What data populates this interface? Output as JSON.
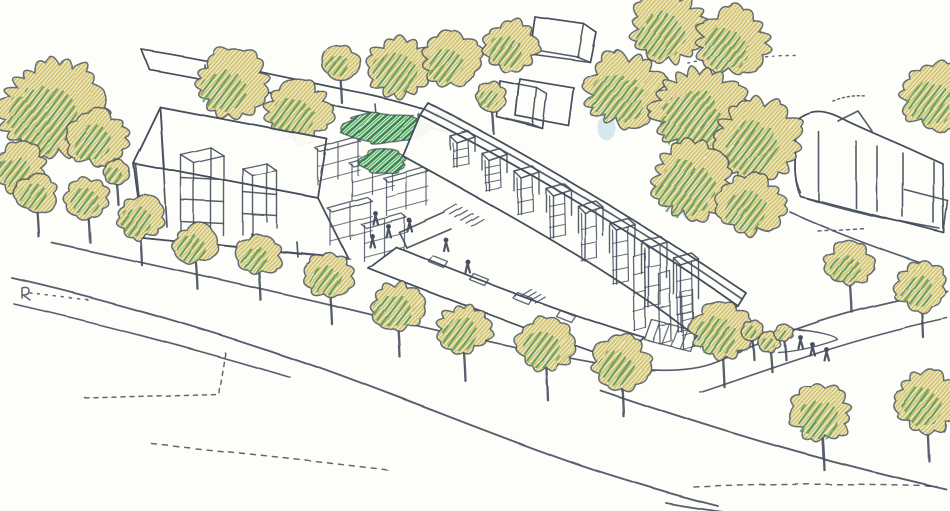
{
  "scene": {
    "description": "Hand-drawn ink and coloured-pencil aerial perspective sketch of a terraced housing scheme with chimney towers, a large gabled hall, background blocks, tree-lined street, roads and small human figures",
    "canvas": {
      "w": 950,
      "h": 511
    },
    "palette": {
      "paper": "#fdfdfa",
      "ink": "#454e5c",
      "foliage_base": "#f5f0d4",
      "foliage_yellow": "#d6c978",
      "foliage_yellow_dark": "#c5b55e",
      "foliage_green": "#5a9a60",
      "foliage_dark_green": "#2f8a4b",
      "foliage_dark_green2": "#4aa05e",
      "shrub_base": "#eef3e2",
      "blue_hint": "#aed3e6"
    },
    "back_trees": [
      [
        52,
        108,
        52,
        0.55,
        0
      ],
      [
        98,
        138,
        30,
        0.5,
        0
      ],
      [
        20,
        168,
        26,
        0.5,
        0
      ],
      [
        37,
        193,
        21,
        0.6,
        1
      ],
      [
        88,
        197,
        22,
        0.55,
        1
      ],
      [
        116,
        172,
        13,
        0.5,
        1
      ],
      [
        232,
        84,
        36,
        0.5,
        0
      ],
      [
        298,
        112,
        33,
        0.55,
        0
      ],
      [
        340,
        62,
        19,
        0.45,
        1
      ],
      [
        400,
        67,
        33,
        0.6,
        0
      ],
      [
        451,
        59,
        29,
        0.5,
        0
      ],
      [
        511,
        45,
        27,
        0.5,
        0
      ],
      [
        492,
        97,
        16,
        0.5,
        1
      ],
      [
        625,
        90,
        40,
        0.55,
        0
      ],
      [
        668,
        28,
        38,
        0.5,
        0
      ],
      [
        732,
        42,
        36,
        0.5,
        0
      ],
      [
        700,
        112,
        46,
        0.6,
        0
      ],
      [
        758,
        140,
        42,
        0.55,
        0
      ],
      [
        692,
        180,
        40,
        0.65,
        0
      ],
      [
        752,
        205,
        33,
        0.5,
        0
      ],
      [
        936,
        96,
        35,
        0.5,
        0
      ],
      [
        850,
        264,
        24,
        0.45,
        1
      ],
      [
        921,
        286,
        26,
        0.5,
        1
      ]
    ],
    "street_trees": [
      [
        140,
        217,
        24,
        0.55
      ],
      [
        196,
        244,
        22,
        0.6
      ],
      [
        259,
        255,
        22,
        0.55
      ],
      [
        330,
        276,
        24,
        0.6
      ],
      [
        398,
        306,
        26,
        0.65
      ],
      [
        464,
        329,
        27,
        0.6
      ],
      [
        546,
        345,
        29,
        0.6
      ],
      [
        621,
        362,
        28,
        0.55
      ],
      [
        722,
        330,
        30,
        0.6
      ],
      [
        822,
        413,
        30,
        0.6
      ],
      [
        927,
        400,
        33,
        0.5
      ],
      [
        752,
        330,
        11,
        0.45
      ],
      [
        770,
        342,
        11,
        0.5
      ],
      [
        784,
        333,
        9,
        0.45
      ]
    ],
    "shrubs": [
      [
        385,
        128,
        42,
        15
      ],
      [
        383,
        162,
        24,
        13
      ]
    ],
    "blue_hints": [
      [
        648,
        12,
        13,
        8
      ],
      [
        607,
        128,
        9,
        13
      ],
      [
        589,
        203,
        7,
        11
      ],
      [
        688,
        209,
        7,
        10
      ]
    ],
    "figures": {
      "plaza": [
        [
          375,
          216
        ],
        [
          388,
          229
        ],
        [
          409,
          223
        ],
        [
          372,
          239
        ],
        [
          446,
          243
        ],
        [
          468,
          265
        ]
      ],
      "junction": [
        [
          800,
          340
        ],
        [
          812,
          347
        ],
        [
          826,
          352
        ]
      ]
    },
    "roads": [
      {
        "name": "kerb-line",
        "d": "M52,243 C140,262 240,284 330,305 C420,327 520,350 600,364 C650,372 690,372 715,362 C750,347 790,330 830,318 C870,306 915,296 947,291",
        "w": 1.7
      },
      {
        "name": "road-far-edge",
        "d": "M12,278 C110,300 220,333 320,368 C420,404 520,446 600,472 C650,488 690,499 718,506",
        "w": 1.9
      },
      {
        "name": "road-near-edge",
        "d": "M14,304 C110,326 200,350 290,377",
        "w": 1.6
      },
      {
        "name": "road-lower-edge",
        "d": "M600,390 C700,424 800,456 946,489",
        "w": 1.9
      },
      {
        "name": "branch-road-edge",
        "d": "M700,392 C760,372 820,350 880,334 C910,326 932,321 947,318",
        "w": 1.6
      },
      {
        "name": "road-bottom-edge",
        "d": "M666,503 C720,513 760,516 806,520",
        "w": 1.7
      },
      {
        "name": "junction-wedge",
        "d": "M792,329 C818,331 836,336 837,339 C818,346 796,351 778,352",
        "w": 1.4
      }
    ],
    "dashed": [
      {
        "name": "plot-boundary-dash",
        "d": "M85,398 L218,394 L225,352",
        "dash": "4 5"
      },
      {
        "name": "bottom-dash-left",
        "d": "M152,444 C230,452 310,460 392,470",
        "dash": "5 6"
      },
      {
        "name": "bottom-dash-right",
        "d": "M694,487 C770,484 860,483 936,486",
        "dash": "5 6"
      },
      {
        "name": "dotted-top-right",
        "d": "M688,63 C720,58 760,55 797,55",
        "dash": "2 5"
      },
      {
        "name": "dotted-roof-ticks",
        "d": "M495,97 C515,92 535,89 556,88",
        "dash": "2 5"
      },
      {
        "name": "dotted-right-block",
        "d": "M818,231 L866,228",
        "dash": "3 4"
      },
      {
        "name": "dotted-left-kerb",
        "d": "M30,293 C50,296 70,298 92,300",
        "dash": "2 6"
      },
      {
        "name": "scribble-right-block",
        "d": "M833,101 C843,97 853,95 866,96",
        "dash": "2 3"
      },
      {
        "name": "r-mark",
        "d": "M22,288 L22,298 M22,288 Q29,286 29,291 Q29,295 23,295 L30,300",
        "dash": ""
      }
    ],
    "buildings": {
      "rear_hall": {
        "fill": "M142,50 C220,62 300,81 352,91 C395,99 432,111 458,121 L464,137 C436,129 398,118 358,110 C308,101 230,84 150,70 Z",
        "strokes": [
          "M142,50 C220,62 300,81 352,91 C395,99 432,111 458,121",
          "M150,70 C230,84 308,101 358,110 C398,118 436,129 464,137",
          "M142,50 L150,70",
          "M458,121 L464,137",
          "M205,65 L206,76",
          "M262,77 L263,88",
          "M318,91 L319,102",
          "M375,104 L376,115",
          "M418,113 L419,124"
        ]
      },
      "mid_blocks": {
        "fills": [
          "M535,17 L584,24 L596,32 L590,62 L530,54 Z",
          "M500,81 L537,88 L547,94 L543,129 L497,117 Z",
          "M520,79 L574,88 L569,126 L516,116 Z"
        ],
        "strokes": [
          "M535,17 L584,24",
          "M584,24 L596,32",
          "M535,17 L530,49",
          "M530,49 L578,57",
          "M578,57 L584,24",
          "M596,32 L590,62",
          "M578,57 L590,62",
          "M500,81 L537,88",
          "M537,88 L533,125",
          "M500,81 L497,117",
          "M497,117 L533,125",
          "M537,88 L547,94",
          "M547,94 L543,129",
          "M533,125 L543,129",
          "M520,79 L574,88",
          "M574,88 L569,126",
          "M520,79 L516,116",
          "M516,116 L569,126"
        ]
      },
      "right_block": {
        "fill": "M793,123 C812,104 830,112 847,121 C868,131 890,140 910,149 L943,164 L944,233 L901,222 L800,196 C789,170 799,149 793,123 Z",
        "strokes": [
          "M793,123 C812,104 830,112 847,121 C868,131 890,140 910,149 L943,164",
          "M838,121 L858,111 L872,131",
          "M793,123 C799,149 789,170 800,192",
          "M818,131 L818,201",
          "M856,141 L856,208",
          "M877,146 L877,211",
          "M903,153 L903,217",
          "M934,162 L934,223",
          "M800,196 C840,209 882,219 940,229",
          "M905,190 L948,201",
          "M948,201 L944,233",
          "M944,233 L901,222",
          "M790,212 C832,231 874,247 922,263"
        ]
      },
      "left_house": {
        "fills": [
          "M160,107 L327,139 L318,198 L133,163 Z",
          "M160,107 L133,163 L143,238 L168,227 Z",
          "M133,163 L318,198 L348,258 L143,238 Z"
        ],
        "strokes": [
          "M133,163 L160,107",
          "M160,107 L327,139",
          "M327,139 L318,198",
          "M318,198 L133,163",
          "M135,164 L143,238",
          "M143,238 L350,259",
          "M348,258 L318,198",
          "M160,108 L167,227",
          "M203,227 L204,245",
          "M252,234 L253,251",
          "M297,242 L298,257"
        ],
        "towers": [
          [
            "M181,155 L211,148",
            "M211,148 L224,156",
            "M224,156 L194,163",
            "M194,163 L181,155",
            "M181,155 L181,242",
            "M211,148 L211,228",
            "M224,156 L224,236",
            "M194,163 L194,248",
            "M181,178 L224,180",
            "M181,200 L224,202",
            "M181,222 L224,224"
          ],
          [
            "M243,169 L267,164",
            "M267,164 L277,171",
            "M277,171 L253,176",
            "M253,176 L243,169",
            "M243,169 L243,235",
            "M267,164 L267,222",
            "M277,171 L277,228",
            "M253,176 L253,240",
            "M243,192 L277,195",
            "M243,214 L277,216"
          ]
        ]
      },
      "terrace": {
        "fills": [
          "M428,103 C530,155 650,228 746,293 L738,306 C645,240 525,168 420,115 Z",
          "M420,115 C525,168 645,240 738,306 L689,331 C610,270 505,212 403,156 Z"
        ],
        "strokes": [
          "M428,103 C530,155 650,228 746,293",
          "M420,115 C525,168 645,240 738,306",
          "M428,103 L420,115",
          "M746,293 L738,306",
          "M420,115 L403,156",
          "M403,156 C505,212 610,270 689,331",
          "M738,306 L689,331",
          "M424,109 C528,161 648,234 742,299",
          "M399,232 L444,212",
          "M407,248 L451,229",
          "M399,232 L407,248"
        ],
        "tower_row": {
          "x0": 450,
          "y0": 136,
          "dx": 32,
          "dy": 17.5,
          "count": 8,
          "w": 18,
          "top_d": 7
        },
        "lower_fill": "M396,247 C470,277 560,312 645,338 L616,360 C540,334 450,300 368,268 Z",
        "lower_strokes": [
          "M396,247 C470,277 560,312 645,338",
          "M368,268 C450,300 540,334 616,360",
          "M396,247 L368,268",
          "M645,338 L616,360"
        ],
        "dormers": [
          [
            433,
            256
          ],
          [
            474,
            274
          ],
          [
            517,
            292
          ],
          [
            560,
            310
          ]
        ],
        "stairs": [
          {
            "x": 444,
            "y": 211,
            "n": 6,
            "sx": 5.4,
            "sy": 2.9,
            "dx": 12,
            "dy": -7
          },
          {
            "x": 521,
            "y": 295,
            "n": 4,
            "sx": 4.6,
            "sy": 2.5,
            "dx": 10,
            "dy": -6
          }
        ],
        "ladders": [
          [
            634,
            257,
            74
          ],
          [
            659,
            274,
            70
          ],
          [
            682,
            293,
            56
          ]
        ],
        "platform": {
          "d": "M652,320 L697,331 L690,351 L645,340 Z",
          "hatch": [
            "M660,323 L653,342",
            "M669,325 L662,344",
            "M678,327 L671,346",
            "M687,330 L680,348"
          ]
        }
      },
      "pergolas": [
        [
          315,
          148
        ],
        [
          349,
          163
        ],
        [
          383,
          178
        ],
        [
          327,
          208
        ],
        [
          361,
          224
        ]
      ]
    }
  }
}
